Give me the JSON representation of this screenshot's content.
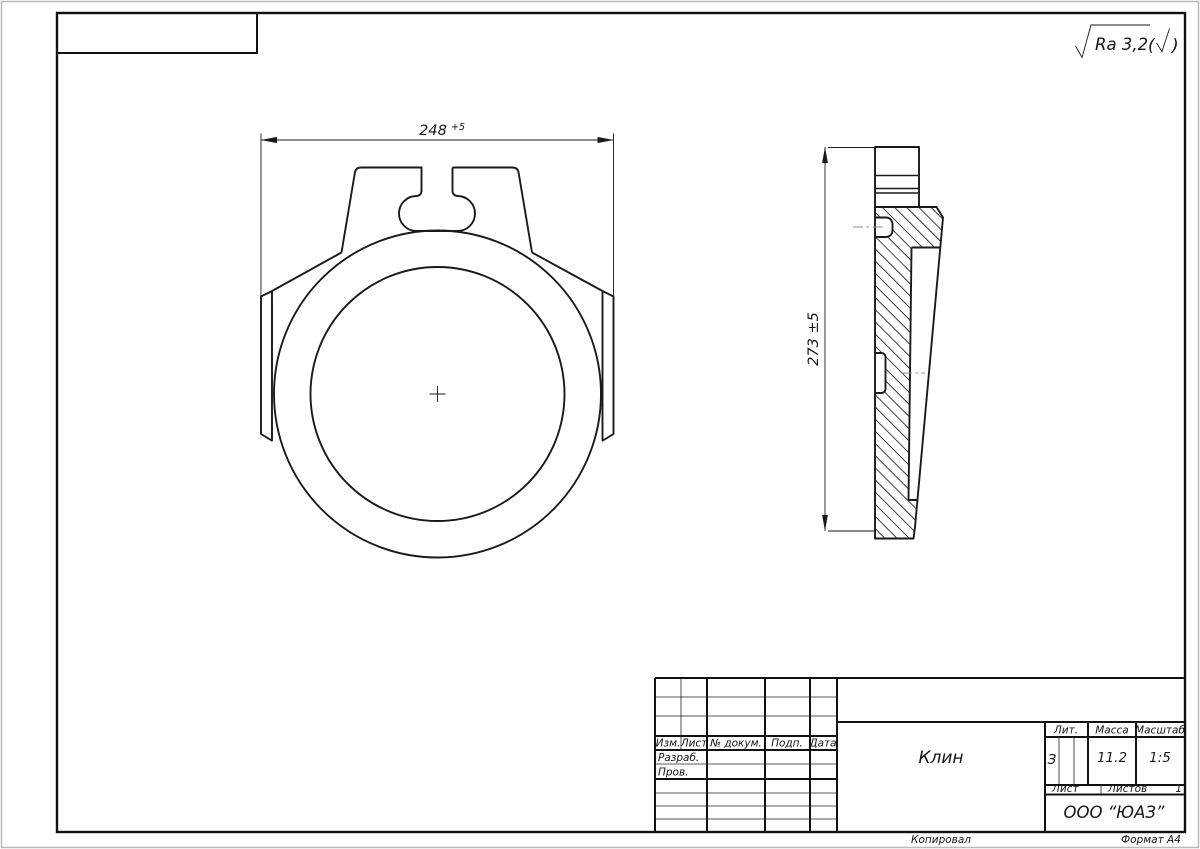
{
  "drawing": {
    "surface_roughness": "Ra 3,2",
    "dim_width": {
      "value": "248",
      "tolerance": "+5"
    },
    "dim_height": {
      "value": "273 ±5"
    }
  },
  "title_block": {
    "col_headers": {
      "izm": "Изм.",
      "list": "Лист",
      "num_doc": "№ докум.",
      "podp": "Подп.",
      "data": "Дата"
    },
    "row_labels": {
      "razrab": "Разраб.",
      "prov": "Пров."
    },
    "prop_headers": {
      "lit": "Лит.",
      "massa": "Масса",
      "masshtab": "Масштаб",
      "list": "Лист",
      "listov": "Листов"
    },
    "values": {
      "name": "Клин",
      "lit": "З",
      "massa": "11.2",
      "masshtab": "1:5",
      "listov_count": "1",
      "company": "ООО “ЮАЗ”"
    }
  },
  "footer": {
    "kopiroval": "Копировал",
    "format": "Формат А4"
  }
}
